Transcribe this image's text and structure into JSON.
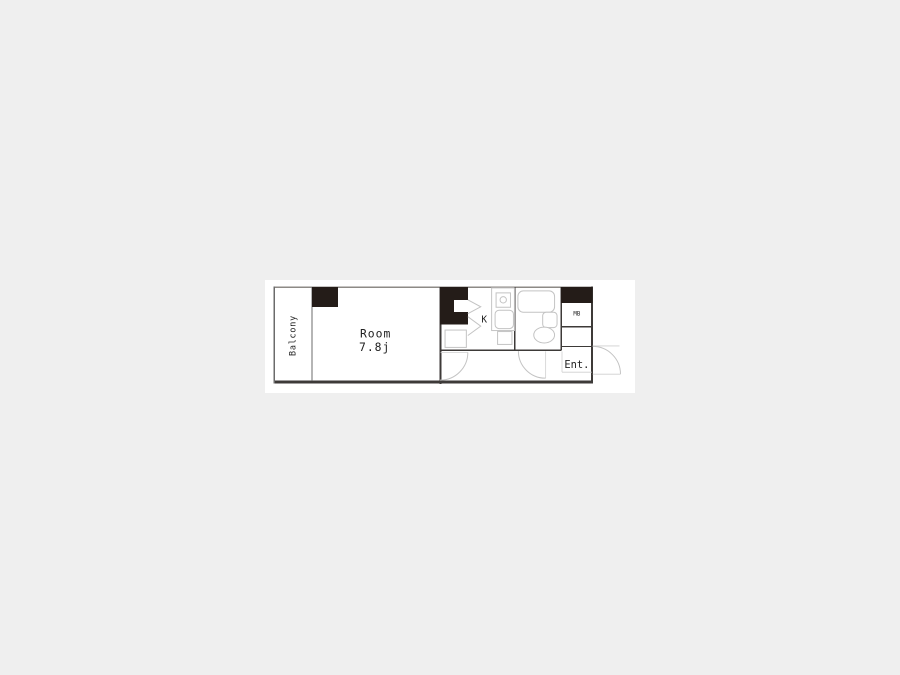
{
  "page": {
    "background_color": "#efefef",
    "canvas_color": "#ffffff"
  },
  "floorplan": {
    "labels": {
      "balcony": "Balcony",
      "room_name": "Room",
      "room_size": "7.8j",
      "kitchen": "K",
      "meter_box": "MB",
      "entrance": "Ent."
    },
    "colors": {
      "wall_dark": "#3d3a38",
      "wall_light": "#8d8a86",
      "pillar": "#241c18",
      "fixture_gray": "#c3c3c3",
      "text": "#222222"
    }
  }
}
